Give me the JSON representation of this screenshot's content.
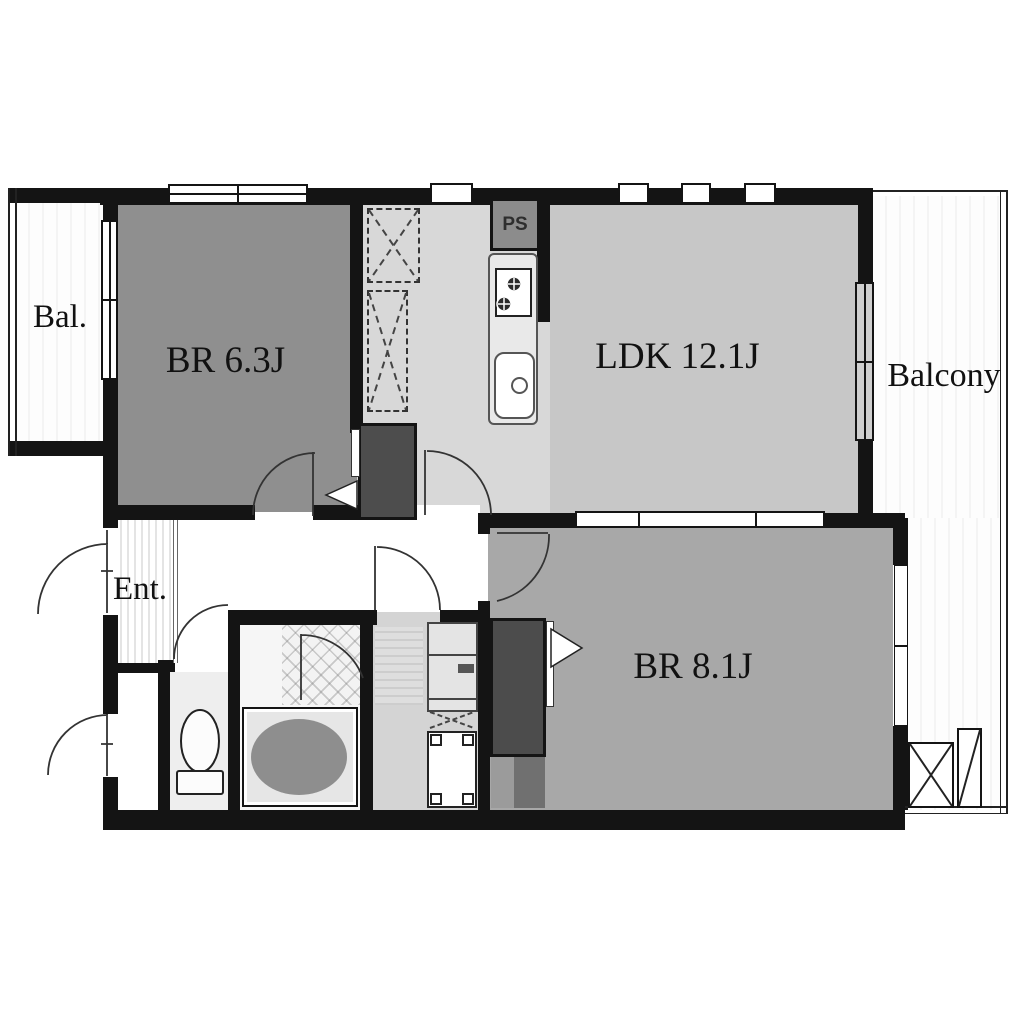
{
  "floorplan": {
    "type": "apartment-floor-plan",
    "rooms": {
      "bal_left": {
        "label": "Bal."
      },
      "br63": {
        "label": "BR 6.3J"
      },
      "ldk": {
        "label": "LDK 12.1J"
      },
      "balcony_right": {
        "label": "Balcony"
      },
      "entrance": {
        "label": "Ent."
      },
      "br81": {
        "label": "BR 8.1J"
      },
      "pipe_shaft": {
        "label": "PS"
      }
    },
    "colors": {
      "wall": "#141414",
      "br63_floor": "#8f8f8f",
      "br81_floor": "#a8a8a8",
      "ldk_floor": "#c7c7c7",
      "kitchen_floor": "#d8d8d8",
      "washroom_floor": "#d4d4d4",
      "toilet_floor": "#eeeeee",
      "closet_dark": "#4d4d4d",
      "bathtub": "#8e8e8e",
      "ps_fill": "#8c8c8c",
      "balcony_floor": "#fdfdfd"
    }
  }
}
